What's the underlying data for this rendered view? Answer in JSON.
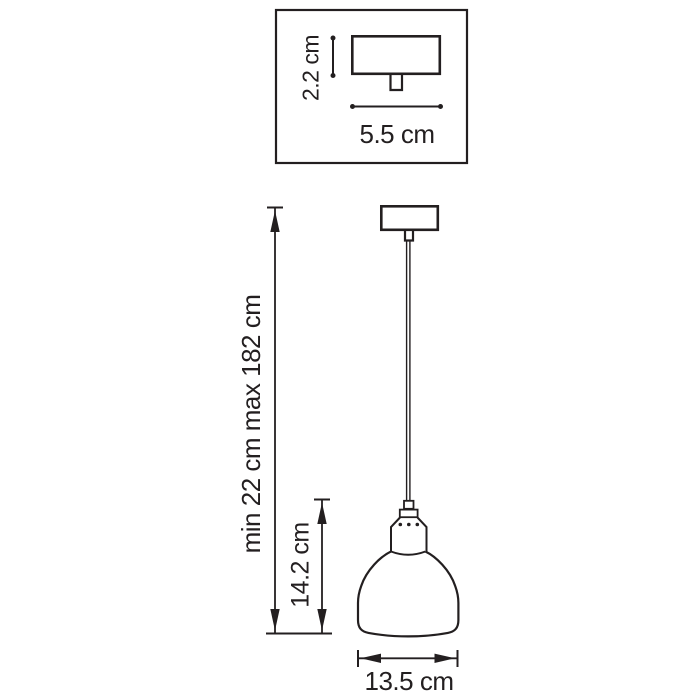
{
  "drawing": {
    "background_color": "#ffffff",
    "line_color": "#231f20",
    "detail_view": {
      "canopy_height": "2.2 cm",
      "canopy_width": "5.5 cm"
    },
    "main_view": {
      "overall_height": "min 22 cm max 182 cm",
      "shade_height": "14.2 cm",
      "shade_width": "13.5 cm"
    }
  }
}
